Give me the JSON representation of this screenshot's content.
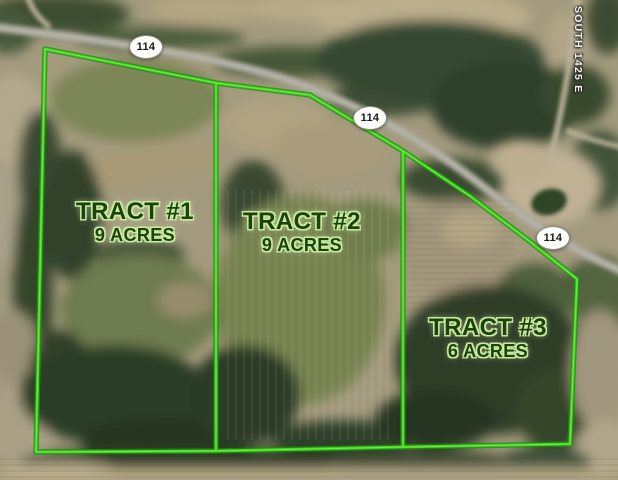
{
  "map": {
    "description": "Aerial parcel map showing three subdivided land tracts along Route 114",
    "tracts": [
      {
        "id": "tract-1",
        "label": "TRACT #1",
        "acreage": "9 ACRES"
      },
      {
        "id": "tract-2",
        "label": "TRACT #2",
        "acreage": "9 ACRES"
      },
      {
        "id": "tract-3",
        "label": "TRACT #3",
        "acreage": "6 ACRES"
      }
    ],
    "route_badges": [
      {
        "id": "route-114-west",
        "label": "114"
      },
      {
        "id": "route-114-middle",
        "label": "114"
      },
      {
        "id": "route-114-east",
        "label": "114"
      }
    ],
    "road_name": "SOUTH 1425 E",
    "colors": {
      "boundary_green": "#3fd41e",
      "boundary_glow": "#1d9110",
      "label_text": "#1c430d",
      "label_halo": "#cbeca2",
      "road_gray": "#a7a59a",
      "gravel_tan": "#c0b194",
      "field_tan": "#b3a887",
      "field_olive": "#76824f",
      "woods_dark": "#2c3c26",
      "pond_green": "#2f4428",
      "badge_bg": "#fdfdfa",
      "badge_text": "#191919",
      "road_label_text": "#f3f3ee"
    }
  }
}
